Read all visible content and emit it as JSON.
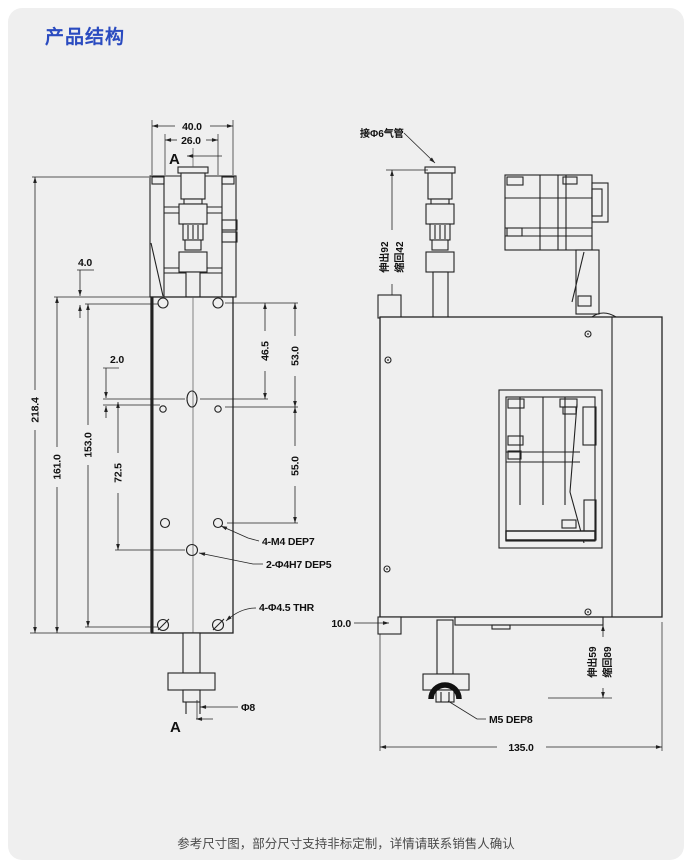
{
  "title": "产品结构",
  "footer_note": "参考尺寸图，部分尺寸支持非标定制，详情请联系销售人确认",
  "front_view": {
    "section_label_top": "A",
    "section_label_bottom": "A",
    "dims": {
      "outer_width": "40.0",
      "inner_width": "26.0",
      "top_offset": "4.0",
      "mid_offset": "2.0",
      "total_height": "218.4",
      "body_height": "161.0",
      "hole_span_height": "153.0",
      "pin_hole_spacing": "72.5",
      "row1_to_pin": "46.5",
      "row1_to_row2": "53.0",
      "row2_to_row3": "55.0",
      "shaft_diameter": "Φ8"
    },
    "callouts": {
      "mounting_holes": "4-M4 DEP7",
      "dowel_holes": "2-Φ4H7 DEP5",
      "through_holes": "4-Φ4.5 THR"
    }
  },
  "side_view": {
    "callouts": {
      "air_fitting": "接Φ6气管",
      "tip_thread": "M5 DEP8"
    },
    "dims": {
      "upper_stroke_extend": "伸出92",
      "upper_stroke_retract": "缩回42",
      "foot_block": "10.0",
      "lower_stroke_extend": "伸出59",
      "lower_stroke_retract": "缩回89",
      "depth": "135.0"
    }
  },
  "colors": {
    "accent": "#2a4bc0",
    "line": "#222222",
    "panel": "#efefef"
  }
}
